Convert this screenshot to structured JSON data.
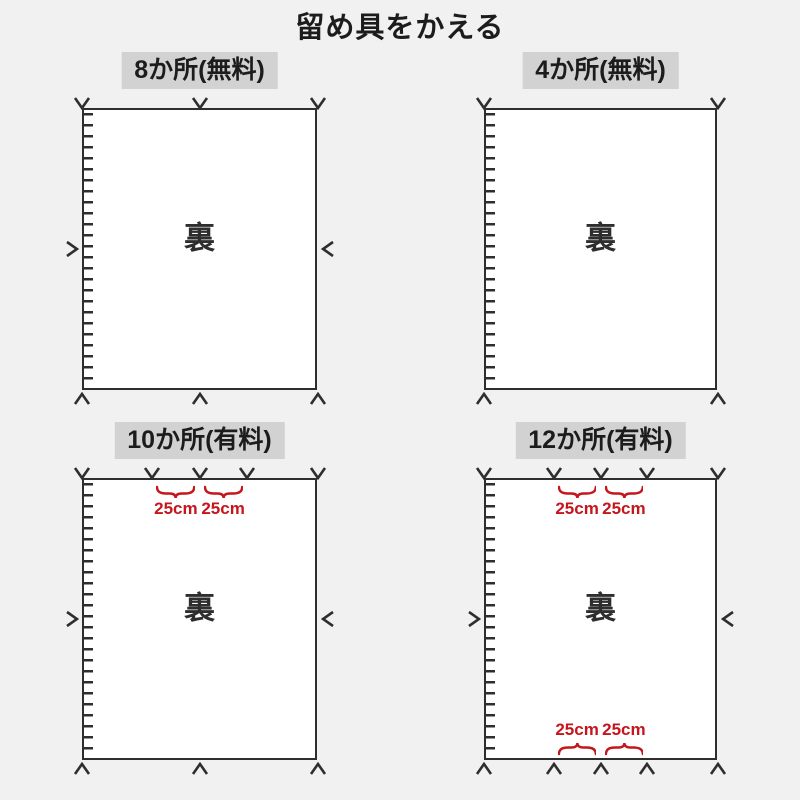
{
  "title": "留め具をかえる",
  "colors": {
    "background": "#f1f1f1",
    "line": "#2e2e2e",
    "label_bg": "#d2d2d2",
    "accent_red": "#c4161c",
    "panel_bg": "#ffffff",
    "text": "#1c1c1c"
  },
  "measure_unit_text": "25cm",
  "panels": [
    {
      "label": "8か所(無料)",
      "back_label": "裏",
      "price_type": "free",
      "fastener_count": 8,
      "top_mark_positions": [
        0,
        0.5,
        1
      ],
      "bottom_mark_positions": [
        0,
        0.5,
        1
      ],
      "side_marks": true,
      "top_measures": [],
      "bottom_measures": []
    },
    {
      "label": "4か所(無料)",
      "back_label": "裏",
      "price_type": "free",
      "fastener_count": 4,
      "top_mark_positions": [
        0,
        1
      ],
      "bottom_mark_positions": [
        0,
        1
      ],
      "side_marks": false,
      "top_measures": [],
      "bottom_measures": []
    },
    {
      "label": "10か所(有料)",
      "back_label": "裏",
      "price_type": "paid",
      "fastener_count": 10,
      "top_mark_positions": [
        0,
        0.3,
        0.5,
        0.7,
        1
      ],
      "bottom_mark_positions": [
        0,
        0.5,
        1
      ],
      "side_marks": true,
      "top_measures": [
        {
          "from": 0.3,
          "to": 0.5,
          "text": "25cm"
        },
        {
          "from": 0.5,
          "to": 0.7,
          "text": "25cm"
        }
      ],
      "bottom_measures": []
    },
    {
      "label": "12か所(有料)",
      "back_label": "裏",
      "price_type": "paid",
      "fastener_count": 12,
      "top_mark_positions": [
        0,
        0.3,
        0.5,
        0.7,
        1
      ],
      "bottom_mark_positions": [
        0,
        0.3,
        0.5,
        0.7,
        1
      ],
      "side_marks": true,
      "top_measures": [
        {
          "from": 0.3,
          "to": 0.5,
          "text": "25cm"
        },
        {
          "from": 0.5,
          "to": 0.7,
          "text": "25cm"
        }
      ],
      "bottom_measures": [
        {
          "from": 0.3,
          "to": 0.5,
          "text": "25cm"
        },
        {
          "from": 0.5,
          "to": 0.7,
          "text": "25cm"
        }
      ]
    }
  ]
}
